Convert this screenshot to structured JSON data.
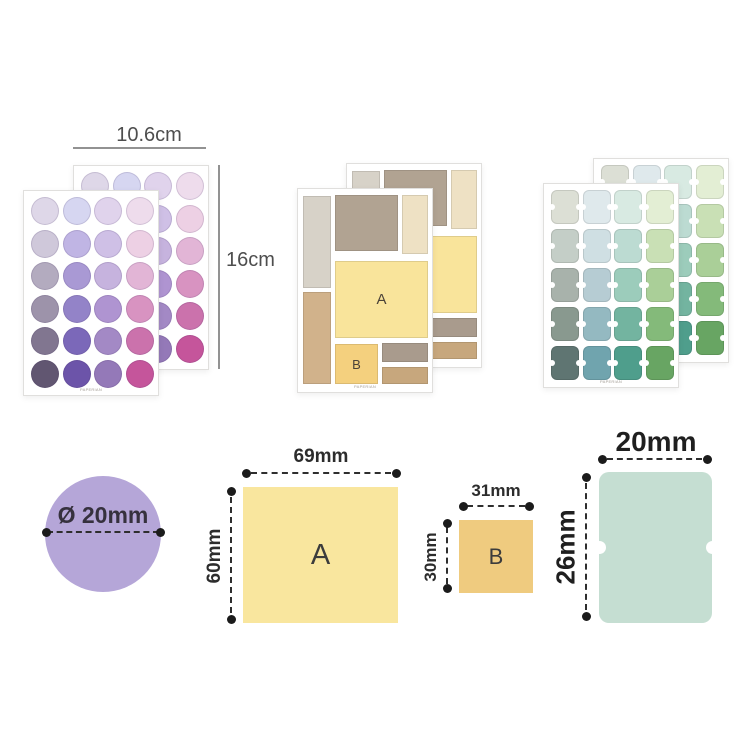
{
  "header_dimensions": {
    "width_label": "10.6cm",
    "height_label": "16cm"
  },
  "brand_text": "PAPERIAN",
  "sheets": {
    "dot_sheet": {
      "rows": 6,
      "cols": 4,
      "colors": [
        [
          "#ded7e8",
          "#d6d6f1",
          "#e0d3ec",
          "#eedcec"
        ],
        [
          "#cfc8da",
          "#c0b5e4",
          "#cfc0e6",
          "#edd0e4"
        ],
        [
          "#b3abbf",
          "#a999d4",
          "#c6b3de",
          "#e2b5d6"
        ],
        [
          "#9d93aa",
          "#9383c8",
          "#af94d1",
          "#d893c1"
        ],
        [
          "#817690",
          "#7b68b9",
          "#a389c5",
          "#cb72ac"
        ],
        [
          "#615671",
          "#6c54a9",
          "#9479b8",
          "#c5559b"
        ]
      ]
    },
    "block_sheet": {
      "blocks": [
        {
          "x": 5,
          "y": 7,
          "w": 28,
          "h": 92,
          "color": "#d7d2c8"
        },
        {
          "x": 5,
          "y": 103,
          "w": 28,
          "h": 92,
          "color": "#d1b28b"
        },
        {
          "x": 37,
          "y": 6,
          "w": 63,
          "h": 56,
          "color": "#b1a392"
        },
        {
          "x": 104,
          "y": 6,
          "w": 26,
          "h": 59,
          "color": "#eee1c4"
        },
        {
          "x": 37,
          "y": 72,
          "w": 93,
          "h": 77,
          "color": "#f9e49b",
          "label": "A"
        },
        {
          "x": 37,
          "y": 155,
          "w": 43,
          "h": 40,
          "color": "#f4d07e",
          "label": "B"
        },
        {
          "x": 84,
          "y": 154,
          "w": 46,
          "h": 19,
          "color": "#a99b8d"
        },
        {
          "x": 84,
          "y": 178,
          "w": 46,
          "h": 17,
          "color": "#c7a77d"
        }
      ]
    },
    "tab_sheet": {
      "rows": 5,
      "cols": 4,
      "colors": [
        [
          "#dcdfd5",
          "#dfe9ec",
          "#d8eae2",
          "#e3eed4"
        ],
        [
          "#c4cec7",
          "#cfdfe3",
          "#bcdbd2",
          "#c9e0b5"
        ],
        [
          "#a8b2ab",
          "#b6ccd3",
          "#9cccbb",
          "#aacf98"
        ],
        [
          "#89998f",
          "#94b9c1",
          "#73b4a0",
          "#84ba7a"
        ],
        [
          "#5f7572",
          "#70a4ae",
          "#4f9e8c",
          "#68a563"
        ]
      ]
    }
  },
  "size_diagrams": {
    "circle": {
      "label": "Ø 20mm",
      "fill": "#b5a6d8"
    },
    "square_a": {
      "letter": "A",
      "width_label": "69mm",
      "height_label": "60mm",
      "fill": "#f9e69e"
    },
    "square_b": {
      "letter": "B",
      "width_label": "31mm",
      "height_label": "30mm",
      "fill": "#efcb7f"
    },
    "tab": {
      "width_label": "20mm",
      "height_label": "26mm",
      "fill": "#c5ded2"
    }
  }
}
